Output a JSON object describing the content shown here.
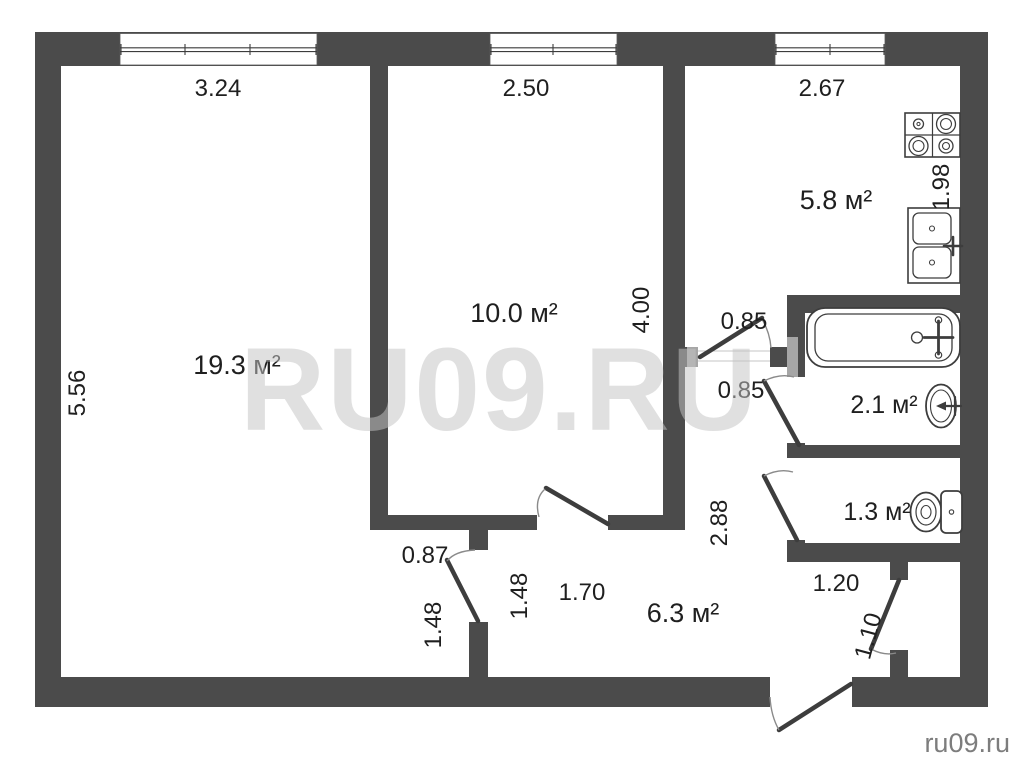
{
  "watermark": {
    "center": "RU09.RU",
    "corner": "ru09.ru"
  },
  "rooms": {
    "living": {
      "label": "19.3 м²"
    },
    "bedroom": {
      "label": "10.0 м²"
    },
    "kitchen": {
      "label": "5.8 м²"
    },
    "bathroom": {
      "label": "2.1 м²"
    },
    "wc": {
      "label": "1.3 м²"
    },
    "hallway": {
      "label": "6.3 м²"
    }
  },
  "dims": {
    "living_width": "3.24",
    "bedroom_width": "2.50",
    "kitchen_width": "2.67",
    "living_height": "5.56",
    "bedroom_height": "4.00",
    "kitchen_depth": "1.98",
    "kitchen_door": "0.85",
    "bathroom_door": "0.85",
    "hallway_length": "2.88",
    "bedroom_door": "1.70",
    "living_door": "0.87",
    "living_door_offset": "1.48",
    "hallway_width": "1.48",
    "vestibule_width": "1.20",
    "vestibule_door": "1.10"
  },
  "colors": {
    "wall": "#4b4b4b",
    "lintel": "#a6a6a6",
    "text": "#1f1f1f",
    "fixture": "#3d3d3d",
    "arc": "#8a8a8a",
    "watermark": "#c4c4c4",
    "corner_mark": "#7d7d7d"
  }
}
